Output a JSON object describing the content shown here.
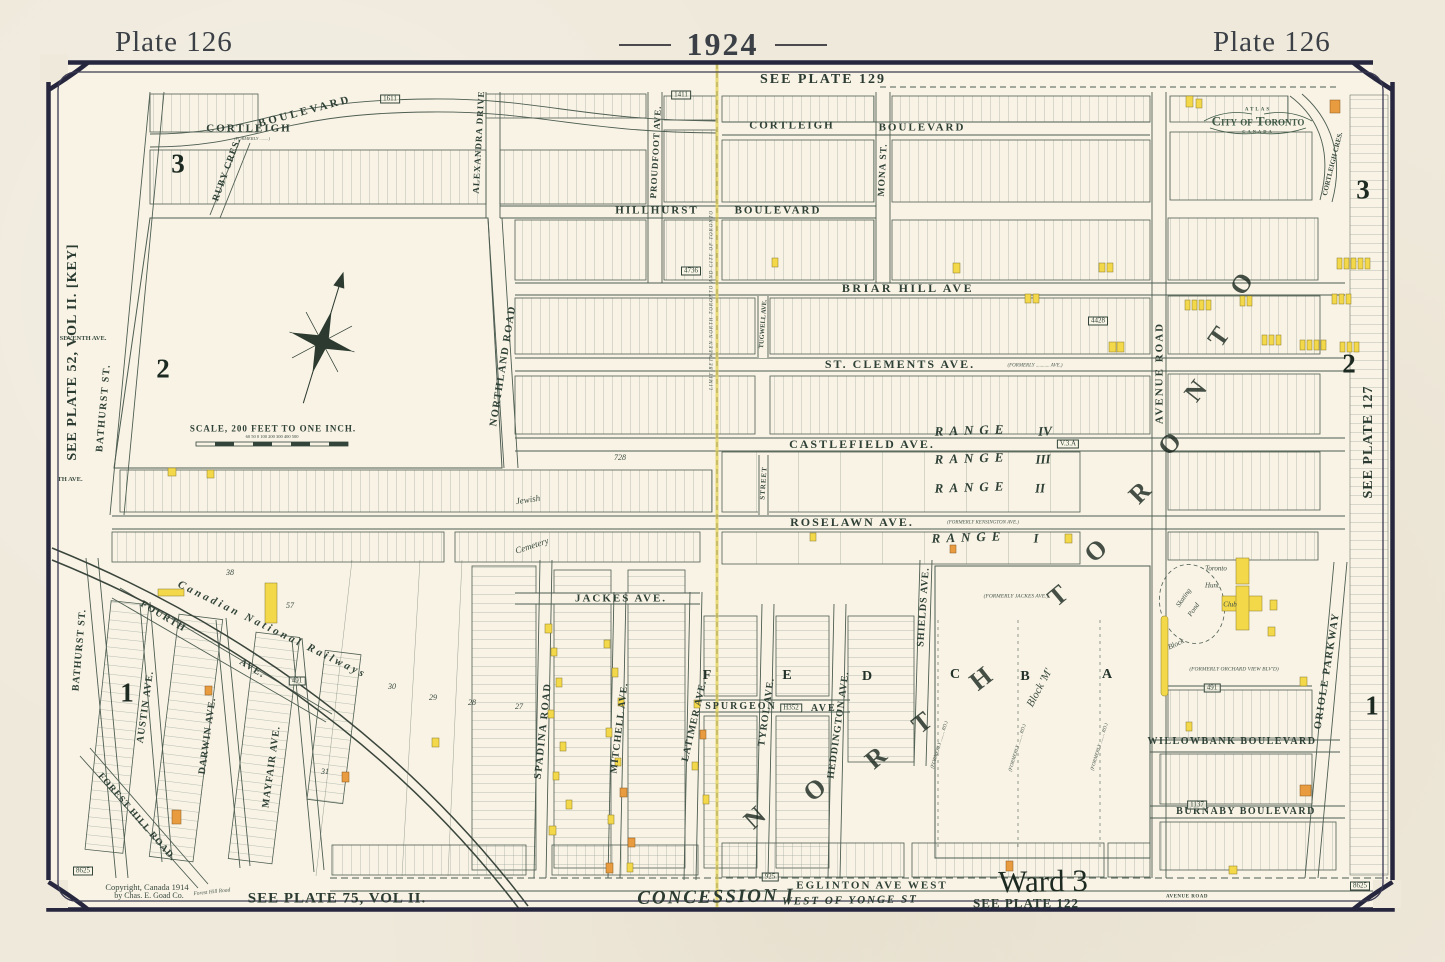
{
  "header": {
    "plate_left": "Plate 126",
    "year": "1924",
    "plate_right": "Plate 126"
  },
  "colors": {
    "paper": "#efe9db",
    "map_paper": "#f8f3e5",
    "border_navy": "#26263e",
    "ink_green": "#33443a",
    "building_yellow": "#f3d84a",
    "building_orange": "#e89b3f",
    "fold_line": "#e3d45c",
    "crest_green": "#3f5946"
  },
  "scale_note": "SCALE, 200 FEET TO ONE INCH.",
  "map_labels": [
    {
      "t": "SEE PLATE 129",
      "x": 823,
      "y": 80,
      "s": 14,
      "ls": 2,
      "c": "plate",
      "n": "edge-label-see-plate-129"
    },
    {
      "t": "SEE PLATE 52, VOL II. [KEY]",
      "x": 73,
      "y": 352,
      "r": -90,
      "s": 14,
      "c": "plate",
      "n": "edge-label-see-plate-52"
    },
    {
      "t": "SEE PLATE 127",
      "x": 1369,
      "y": 442,
      "r": -90,
      "s": 14,
      "c": "plate",
      "n": "edge-label-see-plate-127"
    },
    {
      "t": "SEE PLATE 75, VOL II.",
      "x": 337,
      "y": 899,
      "s": 15,
      "c": "plate",
      "n": "edge-label-see-plate-75"
    },
    {
      "t": "SEE PLATE 122",
      "x": 1026,
      "y": 903,
      "s": 13,
      "c": "plate",
      "n": "edge-label-see-plate-122"
    },
    {
      "t": "Ward 3",
      "x": 1043,
      "y": 881,
      "r": -1,
      "s": 31,
      "c": "ward",
      "n": "ward-label"
    },
    {
      "t": "CONCESSION I",
      "x": 716,
      "y": 897,
      "r": -1,
      "s": 19,
      "ls": 2,
      "c": "conc",
      "n": "concession-label"
    },
    {
      "t": "WEST OF YONGE ST",
      "x": 850,
      "y": 901,
      "r": -1,
      "s": 11,
      "ls": 2,
      "c": "conc"
    },
    {
      "t": "Copyright, Canada 1914",
      "x": 147,
      "y": 887,
      "s": 8.5,
      "c": "tiny",
      "n": "copyright-line-1"
    },
    {
      "t": "by Chas. E. Goad Co.",
      "x": 149,
      "y": 896,
      "s": 8,
      "c": "tiny",
      "n": "copyright-line-2"
    },
    {
      "t": "Forest Hill Road",
      "x": 212,
      "y": 893,
      "r": -6,
      "s": 5.5,
      "c": "tinyit"
    },
    {
      "t": "AVENUE ROAD",
      "x": 1187,
      "y": 897,
      "s": 5,
      "ls": 0.5,
      "c": "tinystreet"
    },
    {
      "t": "CORTLEIGH",
      "x": 249,
      "y": 129,
      "s": 11,
      "ls": 2,
      "c": "street"
    },
    {
      "t": "(FORMERLY ........)",
      "x": 252,
      "y": 139,
      "s": 4.5,
      "c": "tinyit"
    },
    {
      "t": "BOULEVARD",
      "x": 305,
      "y": 112,
      "r": -15,
      "s": 11,
      "ls": 3,
      "c": "street"
    },
    {
      "t": "CORTLEIGH",
      "x": 792,
      "y": 126,
      "s": 11,
      "ls": 2,
      "c": "street"
    },
    {
      "t": "BOULEVARD",
      "x": 922,
      "y": 128,
      "s": 11,
      "ls": 2,
      "c": "street"
    },
    {
      "t": "HILLHURST",
      "x": 657,
      "y": 211,
      "s": 11,
      "ls": 2,
      "c": "street"
    },
    {
      "t": "BOULEVARD",
      "x": 778,
      "y": 211,
      "s": 11,
      "ls": 2,
      "c": "street"
    },
    {
      "t": "BRIAR HILL AVE",
      "x": 908,
      "y": 288,
      "s": 12,
      "ls": 2.5,
      "c": "street"
    },
    {
      "t": "ST. CLEMENTS AVE.",
      "x": 900,
      "y": 364,
      "s": 12,
      "ls": 2,
      "c": "street"
    },
    {
      "t": "(FORMERLY ........... AVE.)",
      "x": 1035,
      "y": 366,
      "s": 5,
      "c": "tinyit"
    },
    {
      "t": "CASTLEFIELD AVE.",
      "x": 862,
      "y": 444,
      "s": 12,
      "ls": 2,
      "c": "street"
    },
    {
      "t": "ROSELAWN AVE.",
      "x": 852,
      "y": 522,
      "s": 12,
      "ls": 2,
      "c": "street"
    },
    {
      "t": "(FORMERLY KENSINGTON AVE.)",
      "x": 983,
      "y": 523,
      "s": 5,
      "c": "tinyit"
    },
    {
      "t": "JACKES AVE.",
      "x": 621,
      "y": 599,
      "s": 11,
      "ls": 2,
      "c": "street"
    },
    {
      "t": "SPURGEON",
      "x": 741,
      "y": 707,
      "s": 10,
      "ls": 2,
      "c": "street"
    },
    {
      "t": "AVE.",
      "x": 826,
      "y": 709,
      "s": 10,
      "ls": 2,
      "c": "street"
    },
    {
      "t": "EGLINTON AVE WEST",
      "x": 872,
      "y": 886,
      "s": 11,
      "ls": 2,
      "c": "street"
    },
    {
      "t": "WILLOWBANK BOULEVARD",
      "x": 1232,
      "y": 742,
      "s": 10,
      "ls": 1.5,
      "c": "street"
    },
    {
      "t": "BURNABY BOULEVARD",
      "x": 1246,
      "y": 812,
      "s": 10,
      "ls": 1.5,
      "c": "street"
    },
    {
      "t": "BATHURST ST.",
      "x": 104,
      "y": 408,
      "r": -85,
      "s": 10,
      "ls": 1.5,
      "c": "street"
    },
    {
      "t": "BATHURST ST.",
      "x": 80,
      "y": 650,
      "r": -85,
      "s": 10,
      "ls": 1,
      "c": "street"
    },
    {
      "t": "FOREST HILL ROAD.",
      "x": 136,
      "y": 818,
      "r": 49,
      "s": 9.5,
      "ls": 1,
      "c": "street"
    },
    {
      "t": "FOURTH",
      "x": 163,
      "y": 617,
      "r": 31,
      "s": 10,
      "ls": 1.5,
      "c": "street"
    },
    {
      "t": "AVE.",
      "x": 252,
      "y": 669,
      "r": 31,
      "s": 10,
      "ls": 1.5,
      "c": "street"
    },
    {
      "t": "AUSTIN AVE.",
      "x": 146,
      "y": 707,
      "r": -82,
      "s": 10,
      "ls": 1,
      "c": "street"
    },
    {
      "t": "DARWIN AVE.",
      "x": 208,
      "y": 736,
      "r": -82,
      "s": 10,
      "ls": 1,
      "c": "street"
    },
    {
      "t": "MAYFAIR AVE.",
      "x": 272,
      "y": 767,
      "r": -82,
      "s": 10,
      "ls": 1,
      "c": "street"
    },
    {
      "t": "SPADINA ROAD",
      "x": 544,
      "y": 731,
      "r": -84,
      "s": 10.5,
      "ls": 1.5,
      "c": "street"
    },
    {
      "t": "MITCHELL AVE.",
      "x": 620,
      "y": 728,
      "r": -83,
      "s": 10,
      "ls": 1,
      "c": "street"
    },
    {
      "t": "LATIMER AVE.",
      "x": 695,
      "y": 721,
      "r": -77,
      "s": 10,
      "ls": 1,
      "c": "street"
    },
    {
      "t": "TYROL AVE.",
      "x": 767,
      "y": 712,
      "r": -82,
      "s": 10,
      "ls": 1,
      "c": "street"
    },
    {
      "t": "HEDDINGTON AVE.",
      "x": 839,
      "y": 725,
      "r": -82,
      "s": 10,
      "ls": 1,
      "c": "street"
    },
    {
      "t": "SHIELDS AVE.",
      "x": 924,
      "y": 607,
      "r": -86,
      "s": 10,
      "ls": 1,
      "c": "street"
    },
    {
      "t": "NORTHLAND ROAD",
      "x": 504,
      "y": 366,
      "r": -81,
      "s": 10.5,
      "ls": 1.5,
      "c": "street"
    },
    {
      "t": "AVENUE ROAD",
      "x": 1160,
      "y": 373,
      "r": -90,
      "s": 11,
      "ls": 2,
      "c": "street"
    },
    {
      "t": "ORIOLE PARKWAY",
      "x": 1328,
      "y": 671,
      "r": -81,
      "s": 10.5,
      "ls": 1.5,
      "c": "street"
    },
    {
      "t": "ALEXANDRA DRIVE",
      "x": 479,
      "y": 142,
      "r": -87,
      "s": 9,
      "ls": 1,
      "c": "street"
    },
    {
      "t": "PROUDFOOT AVE.",
      "x": 656,
      "y": 152,
      "r": -87,
      "s": 9,
      "ls": 1,
      "c": "street"
    },
    {
      "t": "MONA ST.",
      "x": 884,
      "y": 170,
      "r": -87,
      "s": 9.5,
      "ls": 1,
      "c": "street"
    },
    {
      "t": "RUBY CRES.",
      "x": 228,
      "y": 170,
      "r": -70,
      "s": 9.5,
      "ls": 1,
      "c": "street"
    },
    {
      "t": "TUGWELL AVE.",
      "x": 764,
      "y": 324,
      "r": -86,
      "s": 6.5,
      "c": "tinystreet"
    },
    {
      "t": "STREET",
      "x": 764,
      "y": 483,
      "r": -86,
      "s": 7,
      "ls": 1,
      "c": "tinystreet"
    },
    {
      "t": "CORTLEIGH CRES.",
      "x": 1333,
      "y": 164,
      "r": -76,
      "s": 7,
      "c": "tinystreet"
    },
    {
      "t": "SEVENTH AVE.",
      "x": 83,
      "y": 339,
      "s": 6.5,
      "c": "tinystreet"
    },
    {
      "t": "TH AVE.",
      "x": 70,
      "y": 480,
      "s": 6.5,
      "c": "tinystreet"
    },
    {
      "t": "Canadian National Railways",
      "x": 272,
      "y": 630,
      "r": 26,
      "s": 11,
      "ls": 3,
      "c": "rail",
      "n": "railway-label"
    },
    {
      "t": "RANGE",
      "x": 972,
      "y": 430,
      "r": -2,
      "s": 13,
      "ls": 6,
      "c": "range"
    },
    {
      "t": "IV",
      "x": 1045,
      "y": 431,
      "r": -2,
      "s": 13,
      "c": "range"
    },
    {
      "t": "RANGE",
      "x": 972,
      "y": 458,
      "r": -2,
      "s": 13,
      "ls": 6,
      "c": "range"
    },
    {
      "t": "III",
      "x": 1043,
      "y": 459,
      "r": -2,
      "s": 13,
      "c": "range"
    },
    {
      "t": "RANGE",
      "x": 972,
      "y": 487,
      "r": -2,
      "s": 13,
      "ls": 6,
      "c": "range"
    },
    {
      "t": "II",
      "x": 1040,
      "y": 488,
      "r": -2,
      "s": 13,
      "c": "range"
    },
    {
      "t": "RANGE",
      "x": 969,
      "y": 537,
      "r": -2,
      "s": 13,
      "ls": 6,
      "c": "range"
    },
    {
      "t": "I",
      "x": 1036,
      "y": 538,
      "r": -2,
      "s": 13,
      "c": "range"
    },
    {
      "t": "N",
      "x": 755,
      "y": 818,
      "r": -42,
      "s": 26,
      "c": "bigletter"
    },
    {
      "t": "O",
      "x": 815,
      "y": 790,
      "r": -40,
      "s": 26,
      "c": "bigletter"
    },
    {
      "t": "R",
      "x": 876,
      "y": 758,
      "r": -40,
      "s": 26,
      "c": "bigletter"
    },
    {
      "t": "T",
      "x": 922,
      "y": 723,
      "r": -38,
      "s": 26,
      "c": "bigletter"
    },
    {
      "t": "H",
      "x": 981,
      "y": 679,
      "r": -38,
      "s": 26,
      "c": "bigletter"
    },
    {
      "t": "T",
      "x": 1058,
      "y": 596,
      "r": -40,
      "s": 26,
      "c": "bigletter"
    },
    {
      "t": "O",
      "x": 1096,
      "y": 551,
      "r": -42,
      "s": 26,
      "c": "bigletter"
    },
    {
      "t": "R",
      "x": 1140,
      "y": 493,
      "r": -45,
      "s": 26,
      "c": "bigletter"
    },
    {
      "t": "O",
      "x": 1170,
      "y": 444,
      "r": -48,
      "s": 26,
      "c": "bigletter"
    },
    {
      "t": "N",
      "x": 1196,
      "y": 391,
      "r": -52,
      "s": 26,
      "c": "bigletter"
    },
    {
      "t": "T",
      "x": 1219,
      "y": 337,
      "r": -55,
      "s": 26,
      "c": "bigletter"
    },
    {
      "t": "O",
      "x": 1242,
      "y": 284,
      "r": -58,
      "s": 26,
      "c": "bigletter"
    },
    {
      "t": "F",
      "x": 707,
      "y": 676,
      "s": 14,
      "c": "blockletter"
    },
    {
      "t": "E",
      "x": 787,
      "y": 676,
      "s": 14,
      "c": "blockletter"
    },
    {
      "t": "D",
      "x": 867,
      "y": 677,
      "s": 14,
      "c": "blockletter"
    },
    {
      "t": "C",
      "x": 955,
      "y": 675,
      "s": 14,
      "c": "blockletter"
    },
    {
      "t": "B",
      "x": 1025,
      "y": 677,
      "s": 14,
      "c": "blockletter"
    },
    {
      "t": "A",
      "x": 1107,
      "y": 675,
      "s": 14,
      "c": "blockletter"
    },
    {
      "t": "3",
      "x": 178,
      "y": 164,
      "s": 27,
      "c": "district"
    },
    {
      "t": "2",
      "x": 163,
      "y": 369,
      "s": 27,
      "c": "district"
    },
    {
      "t": "1",
      "x": 127,
      "y": 693,
      "s": 27,
      "c": "district"
    },
    {
      "t": "3",
      "x": 1363,
      "y": 190,
      "s": 27,
      "c": "district"
    },
    {
      "t": "2",
      "x": 1349,
      "y": 364,
      "s": 27,
      "c": "district"
    },
    {
      "t": "1",
      "x": 1372,
      "y": 706,
      "s": 27,
      "c": "district"
    },
    {
      "t": "1611",
      "x": 390,
      "y": 99,
      "s": 7,
      "c": "boxed"
    },
    {
      "t": "1411",
      "x": 681,
      "y": 95,
      "s": 7,
      "c": "boxed"
    },
    {
      "t": "4736",
      "x": 691,
      "y": 271,
      "s": 7,
      "c": "boxed"
    },
    {
      "t": "4428",
      "x": 1098,
      "y": 321,
      "s": 7,
      "c": "boxed"
    },
    {
      "t": "V.3.A",
      "x": 1068,
      "y": 444,
      "s": 7,
      "c": "boxed"
    },
    {
      "t": "H352",
      "x": 791,
      "y": 708,
      "s": 7,
      "c": "boxed"
    },
    {
      "t": "491",
      "x": 297,
      "y": 681,
      "s": 7,
      "c": "boxed"
    },
    {
      "t": "491",
      "x": 1212,
      "y": 688,
      "s": 7,
      "c": "boxed"
    },
    {
      "t": "1137",
      "x": 1197,
      "y": 805,
      "s": 7,
      "c": "boxed"
    },
    {
      "t": "925",
      "x": 770,
      "y": 877,
      "s": 7,
      "c": "boxed"
    },
    {
      "t": "8625",
      "x": 83,
      "y": 871,
      "s": 7,
      "c": "boxed"
    },
    {
      "t": "8625",
      "x": 1360,
      "y": 886,
      "s": 7,
      "c": "boxed"
    },
    {
      "t": "Jewish",
      "x": 528,
      "y": 500,
      "r": -8,
      "s": 9,
      "c": "script"
    },
    {
      "t": "Cemetery",
      "x": 532,
      "y": 546,
      "r": -18,
      "s": 9,
      "c": "script"
    },
    {
      "t": "Skating",
      "x": 1184,
      "y": 598,
      "r": -55,
      "s": 7,
      "c": "script"
    },
    {
      "t": "Pond",
      "x": 1194,
      "y": 610,
      "r": -55,
      "s": 7,
      "c": "script"
    },
    {
      "t": "Block",
      "x": 1176,
      "y": 644,
      "r": -25,
      "s": 7.5,
      "c": "script"
    },
    {
      "t": "Toronto",
      "x": 1216,
      "y": 569,
      "s": 7,
      "c": "script"
    },
    {
      "t": "Hunt",
      "x": 1212,
      "y": 586,
      "s": 7,
      "c": "script"
    },
    {
      "t": "Club",
      "x": 1230,
      "y": 605,
      "s": 7,
      "c": "script"
    },
    {
      "t": "Block 'M'",
      "x": 1040,
      "y": 688,
      "r": -62,
      "s": 11,
      "c": "script"
    },
    {
      "t": "(FORMERLY JACKES AVE.)",
      "x": 1016,
      "y": 597,
      "s": 5.5,
      "c": "tinyit"
    },
    {
      "t": "(FORMERLY ORCHARD VIEW BLV'D)",
      "x": 1234,
      "y": 670,
      "s": 5.5,
      "c": "tinyit"
    },
    {
      "t": "(FORMERLY ........ RD.)",
      "x": 940,
      "y": 745,
      "r": -73,
      "s": 5,
      "c": "tinyit"
    },
    {
      "t": "(FORMERLY ........ RD.)",
      "x": 1018,
      "y": 748,
      "r": -73,
      "s": 5,
      "c": "tinyit"
    },
    {
      "t": "(FORMERLY ........ RD.)",
      "x": 1100,
      "y": 747,
      "r": -73,
      "s": 5,
      "c": "tinyit"
    },
    {
      "t": "LIMIT BETWEEN NORTH TORONTO AND CITY OF TORONTO",
      "x": 712,
      "y": 300,
      "r": -90,
      "s": 5,
      "ls": 1,
      "c": "tinyit",
      "n": "city-limit-label"
    },
    {
      "t": "38",
      "x": 230,
      "y": 573,
      "s": 8,
      "c": "acre"
    },
    {
      "t": "57",
      "x": 290,
      "y": 606,
      "s": 8,
      "c": "acre"
    },
    {
      "t": "30",
      "x": 392,
      "y": 687,
      "s": 8,
      "c": "acre"
    },
    {
      "t": "29",
      "x": 433,
      "y": 698,
      "s": 8,
      "c": "acre"
    },
    {
      "t": "28",
      "x": 472,
      "y": 703,
      "s": 8,
      "c": "acre"
    },
    {
      "t": "27",
      "x": 519,
      "y": 707,
      "s": 8,
      "c": "acre"
    },
    {
      "t": "31",
      "x": 325,
      "y": 772,
      "s": 8,
      "c": "acre"
    },
    {
      "t": "728",
      "x": 620,
      "y": 458,
      "s": 8,
      "c": "acre"
    },
    {
      "t": "SCALE, 200 FEET TO ONE INCH.",
      "x": 273,
      "y": 429,
      "s": 9,
      "c": "scalelbl",
      "n": "scale-label"
    },
    {
      "t": "60 50 0     100     200     300     400     500",
      "x": 272,
      "y": 437,
      "s": 4.5,
      "c": "tiny"
    },
    {
      "t": "ATLAS",
      "x": 1258,
      "y": 110,
      "s": 5,
      "ls": 2,
      "c": "crest",
      "n": "crest-atlas"
    },
    {
      "t": "City of Toronto",
      "x": 1258,
      "y": 121,
      "s": 13,
      "c": "crestmain",
      "n": "crest-city-of-toronto"
    },
    {
      "t": "CANADA",
      "x": 1258,
      "y": 132,
      "s": 4.5,
      "ls": 2,
      "c": "crest",
      "n": "crest-canada"
    }
  ]
}
